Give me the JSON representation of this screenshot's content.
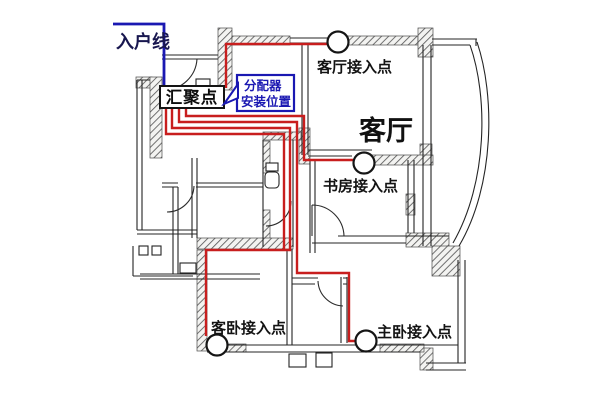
{
  "diagram": {
    "title_hint": "home-network-cabling-floorplan",
    "entry_line": {
      "label": "入户线"
    },
    "convergence_box": {
      "label": "汇聚点"
    },
    "distributor_callout": {
      "line1": "分配器",
      "line2": "安装位置"
    },
    "rooms": {
      "living_room": "客厅"
    },
    "access_points": [
      {
        "id": "living-room",
        "label": "客厅接入点"
      },
      {
        "id": "study",
        "label": "书房接入点"
      },
      {
        "id": "guest-bedroom",
        "label": "客卧接入点"
      },
      {
        "id": "master-bedroom",
        "label": "主卧接入点"
      }
    ],
    "colors": {
      "cable_red": "#c81e1e",
      "entry_blue": "#1a18b2",
      "text_navy": "#18164f",
      "wall_ink": "#242424"
    }
  }
}
